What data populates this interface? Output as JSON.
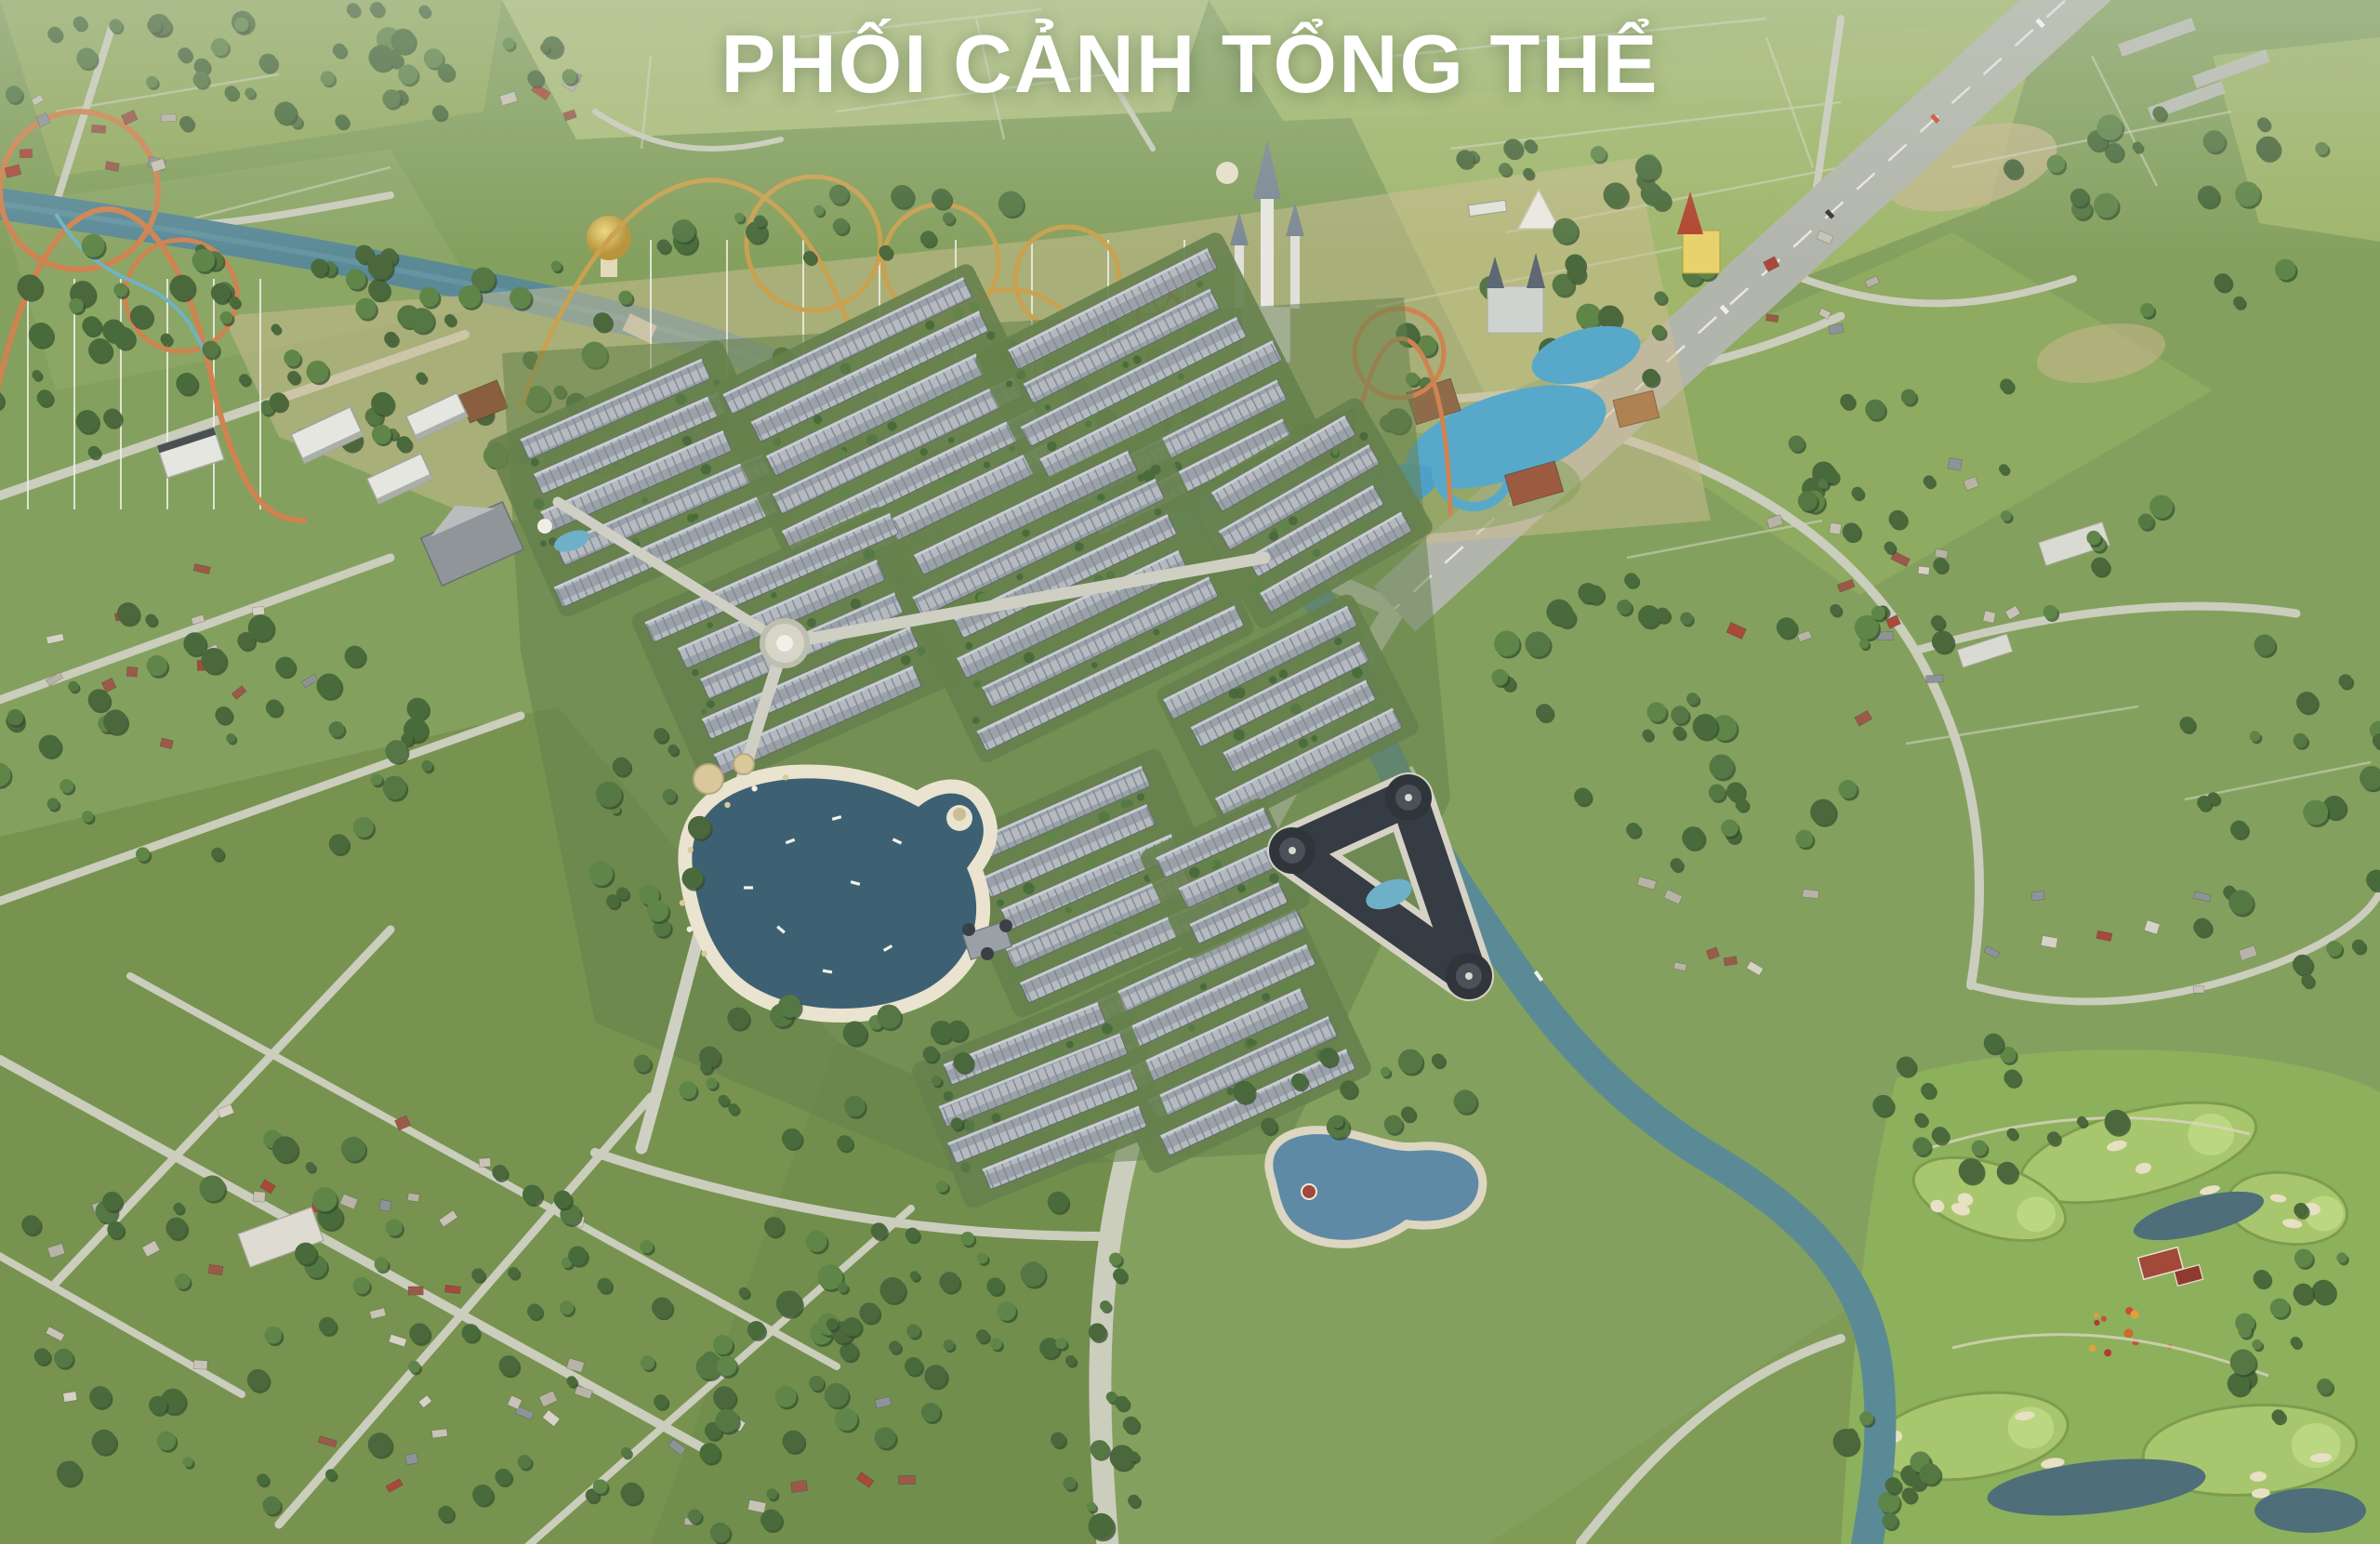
{
  "title": "PHỐI CẢNH TỔNG THỂ",
  "title_color": "#ffffff",
  "scene": {
    "landmarks": [
      "theme-park",
      "roller-coasters",
      "water-park",
      "fairy-castle",
      "canal",
      "housing-estate",
      "high-rise-towers",
      "roundabout",
      "central-lake",
      "beach",
      "lake-clubhouse",
      "hotel-complex",
      "secondary-lake",
      "golf-course",
      "golf-clubhouse",
      "highway",
      "countryside",
      "existing-town"
    ]
  },
  "palette": {
    "base_green": "#84a05e",
    "field_pale": "#b2c27e",
    "field_light": "#a3b96d",
    "field_mid": "#97ad64",
    "field_olive": "#76914e",
    "field_dark": "#6f8c4b",
    "forest_shadow": "#344e2e",
    "tree_greens": [
      "#4a683c",
      "#557744",
      "#5f8549",
      "#496b3b"
    ],
    "road": "#cbcdbd",
    "road_minor": "#bfc1b2",
    "highway": "#b2b5ab",
    "lane": "#e9e9e1",
    "canal": "#5b8a97",
    "lake_water": "#3d6173",
    "lake_sand": "#e9e3cf",
    "lake2_water": "#5e8aa6",
    "lake2_sand": "#ddd6c0",
    "estate_ground": "#66814c",
    "roof_light": "#b4bac0",
    "roof_shade": "#9aa1a8",
    "roof_line": "#81888f",
    "roof_ridge": "#cdd2d6",
    "hotel_roof": "#363c43",
    "hotel_wall": "#d6d3c6",
    "pool_blue": "#6fb0c9",
    "park_sand": "#cdbd92",
    "water_park_blue": "#58a9c9",
    "gold": "#c9a14f",
    "dome_gold": "#d9b84f",
    "coaster_orange": "#cf8350",
    "slide_teal": "#6fb3c4",
    "slide_yellow": "#ddc65e",
    "castle_white": "#e9e7e2",
    "castle_roof": "#7c8894",
    "red_roof": "#a2493a",
    "golf_base": "#8db05c",
    "golf_fairway": "#a8c66e",
    "golf_green": "#bcd781",
    "bunker": "#e8e0c4",
    "golf_pond": "#4e6e7a",
    "white_building": "#e6e6e0",
    "warehouse": "#d9dad2",
    "house_roofs": [
      "#b7b3a6",
      "#c8c3b6",
      "#9b5a49",
      "#8e939a",
      "#d6d2c6",
      "#a8493b"
    ],
    "haze": "#cfd8cc"
  }
}
